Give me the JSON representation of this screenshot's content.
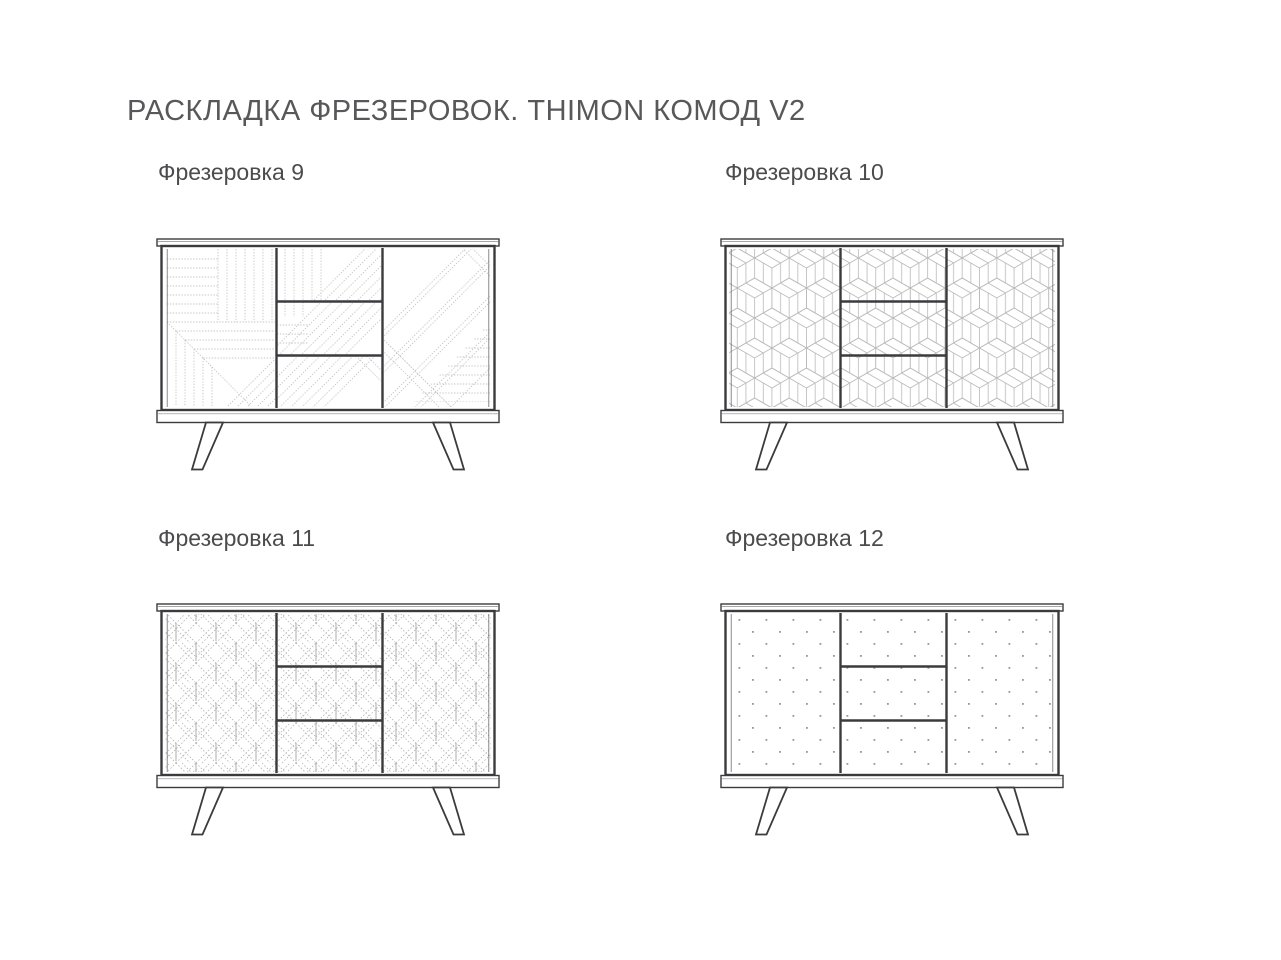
{
  "page": {
    "title": "РАСКЛАДКА ФРЕЗЕРОВОК. THIMON КОМОД V2",
    "background_color": "#ffffff",
    "title_color": "#58585b",
    "label_color": "#4c4c4f",
    "structure_line_color": "#3b3b3e",
    "pattern_line_color": "#c4c4c4"
  },
  "variants": [
    {
      "label": "Фрезеровка 9",
      "pattern": "diagonal-parquet-collage"
    },
    {
      "label": "Фрезеровка 10",
      "pattern": "isometric-cubes"
    },
    {
      "label": "Фрезеровка 11",
      "pattern": "chevron-leaf-diamonds"
    },
    {
      "label": "Фрезеровка 12",
      "pattern": "dot-grid"
    }
  ]
}
